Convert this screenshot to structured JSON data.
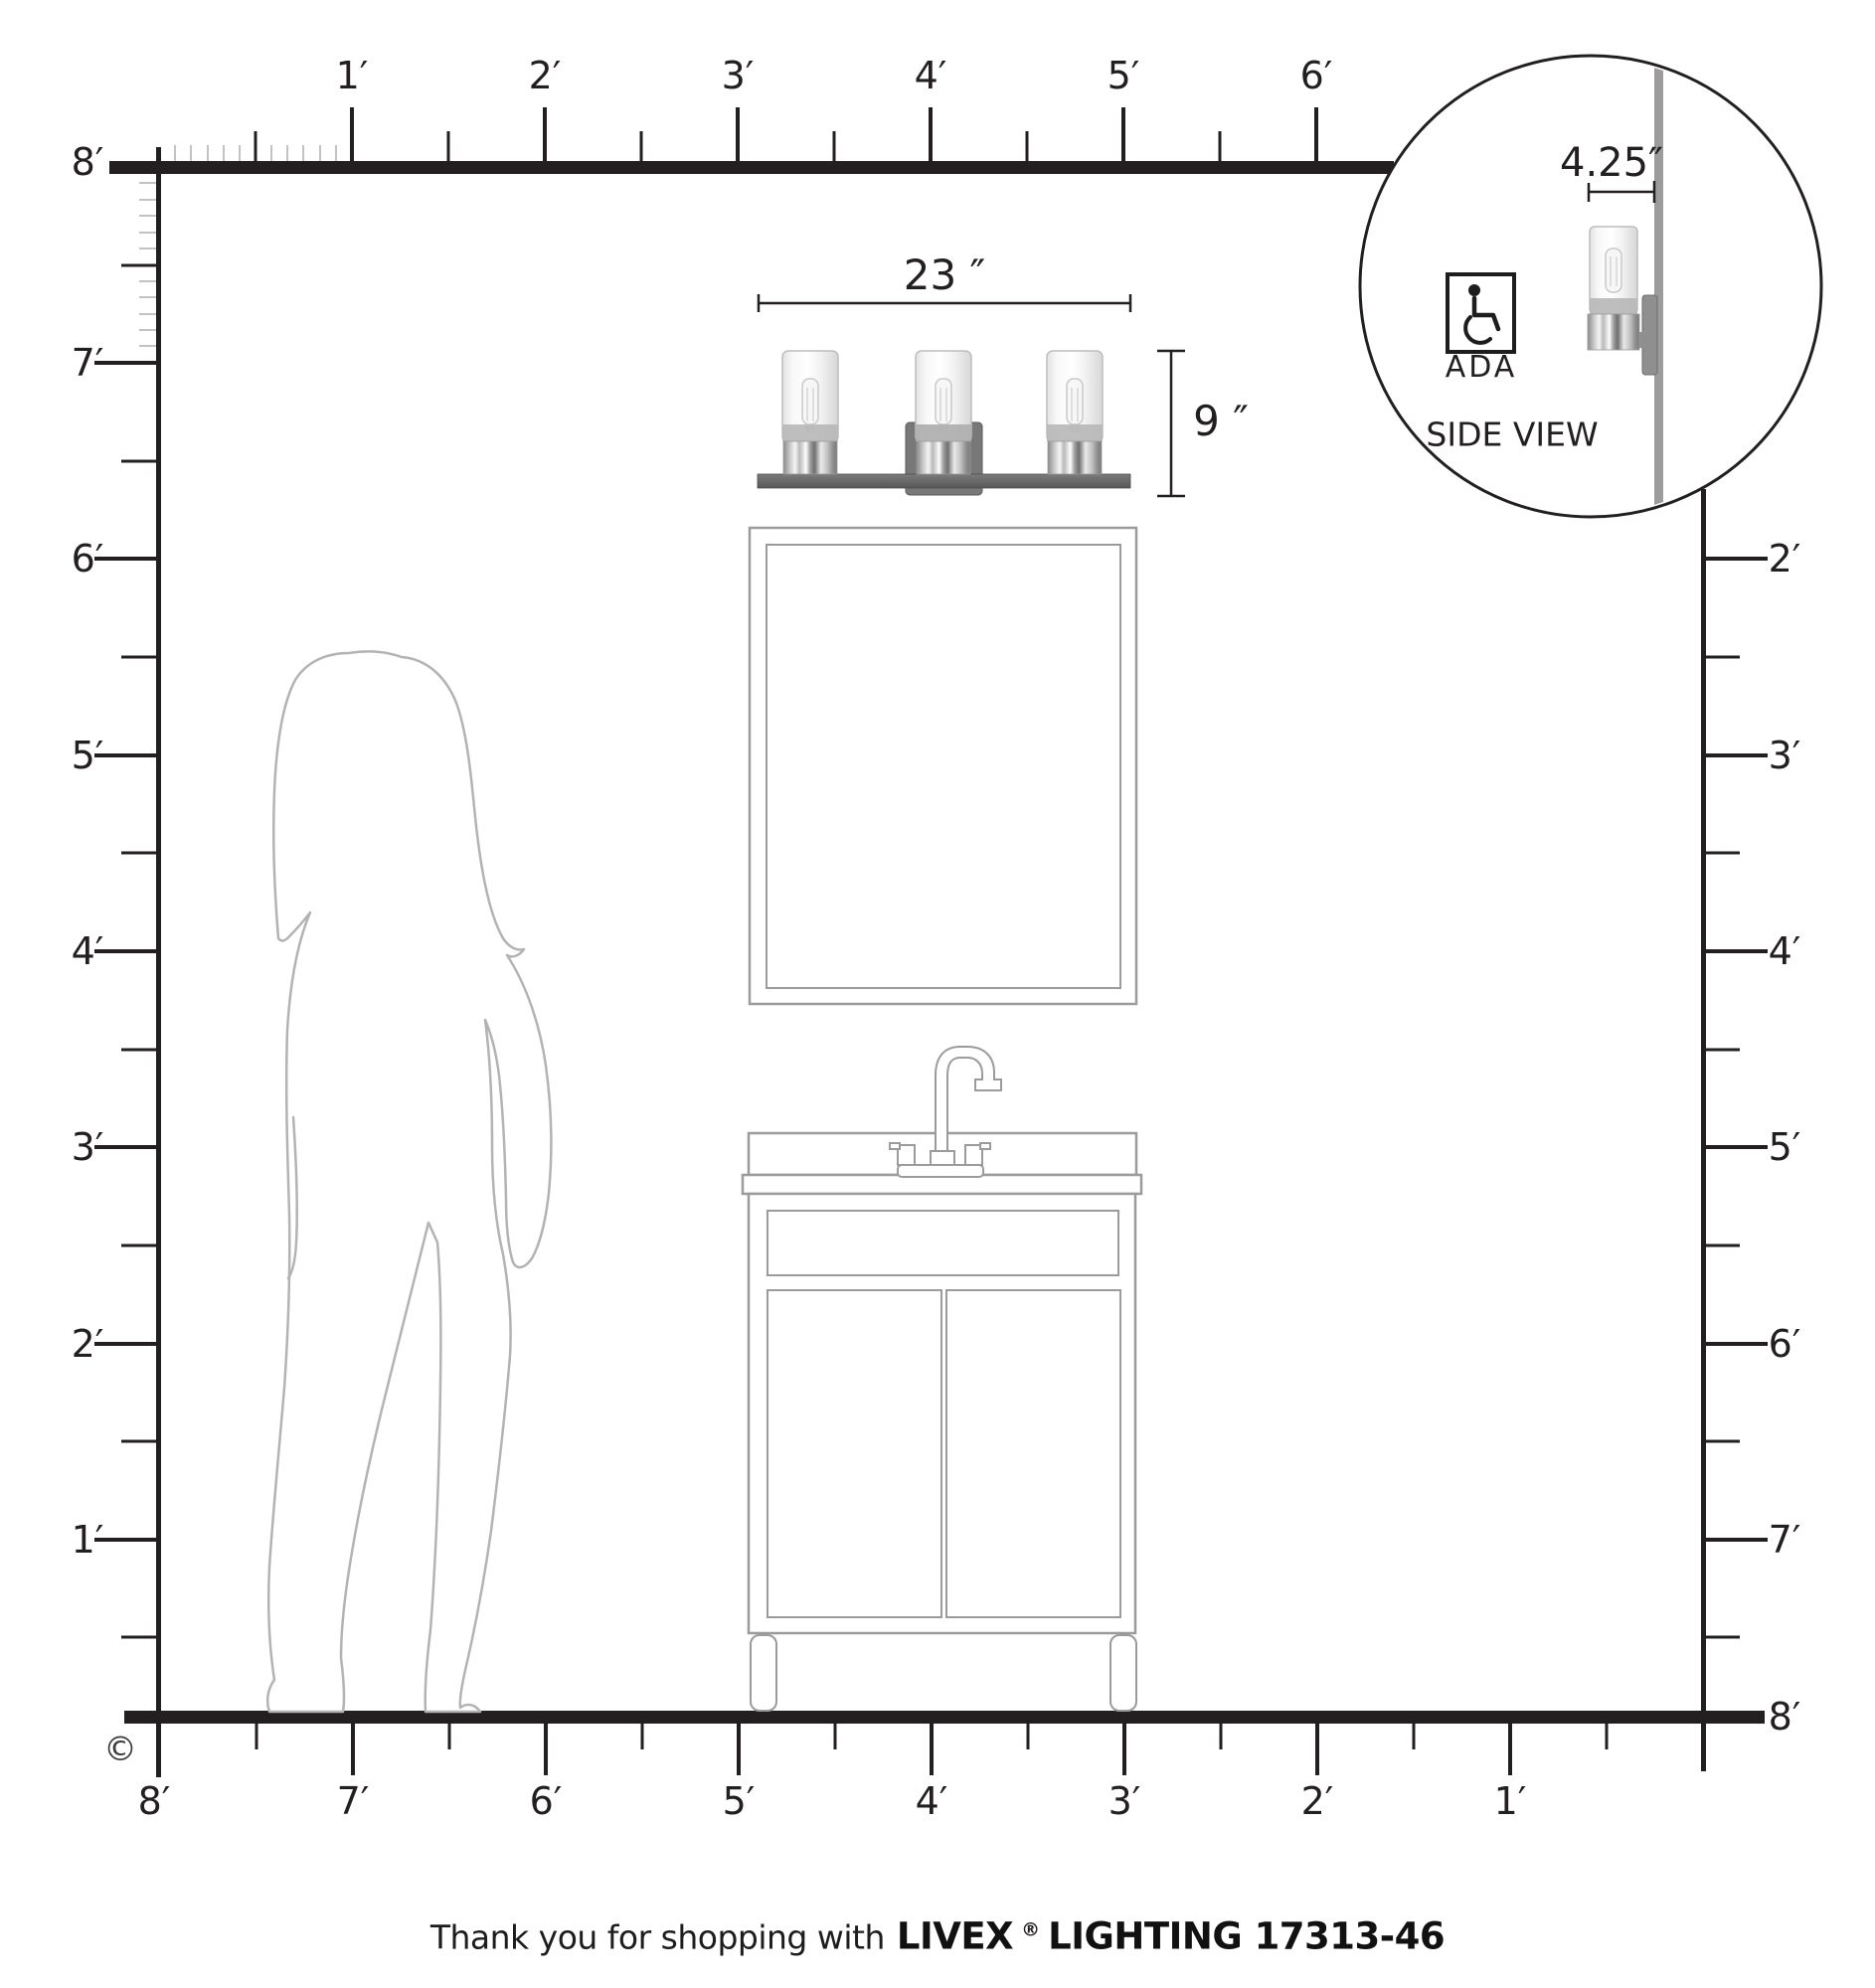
{
  "copyright_symbol": "©",
  "rulers": {
    "top": [
      "1′",
      "2′",
      "3′",
      "4′",
      "5′",
      "6′"
    ],
    "left": [
      "8′",
      "7′",
      "6′",
      "5′",
      "4′",
      "3′",
      "2′",
      "1′"
    ],
    "right": [
      "2′",
      "3′",
      "4′",
      "5′",
      "6′",
      "7′",
      "8′"
    ],
    "bottom": [
      "8′",
      "7′",
      "6′",
      "5′",
      "4′",
      "3′",
      "2′",
      "1′"
    ]
  },
  "fixture": {
    "width_label": "23 ″",
    "height_label": "9 ″",
    "depth_label": "4.25″",
    "light_count": 3
  },
  "inset": {
    "ada_label": "ADA",
    "side_view_label": "SIDE VIEW",
    "wheelchair_icon": "wheelchair-icon"
  },
  "footer": {
    "thanks": "Thank you for shopping with",
    "brand": "LIVEX",
    "registered": "®",
    "product": "LIGHTING 17313-46"
  },
  "colors": {
    "line": "#231f20",
    "outline_gray": "#9b9b9b",
    "silhouette_gray": "#b3b3b3",
    "fixture_gray": "#6a6a6a",
    "wall_gray": "#9c9c9c"
  }
}
